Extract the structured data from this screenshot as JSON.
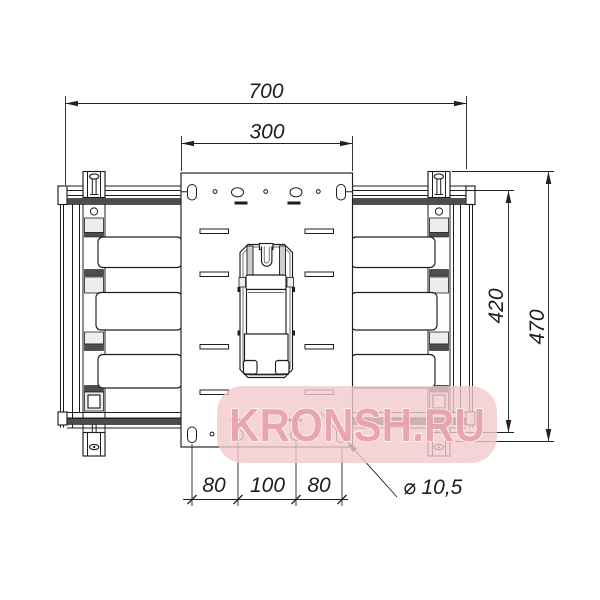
{
  "drawing": {
    "title": "wall-mount-bracket-front-view",
    "line_color": "#1d1d1d",
    "dims": {
      "overall_width": "700",
      "plate_width": "300",
      "rail_height": "420",
      "overall_height": "470",
      "hole_pitch_left": "80",
      "hole_pitch_center": "100",
      "hole_pitch_right": "80",
      "hole_diameter": "⌀ 10,5"
    },
    "watermark": {
      "text": "KRONSH.RU",
      "bg_color": "#f3c9ce",
      "text_color": "#e9a2aa"
    }
  }
}
